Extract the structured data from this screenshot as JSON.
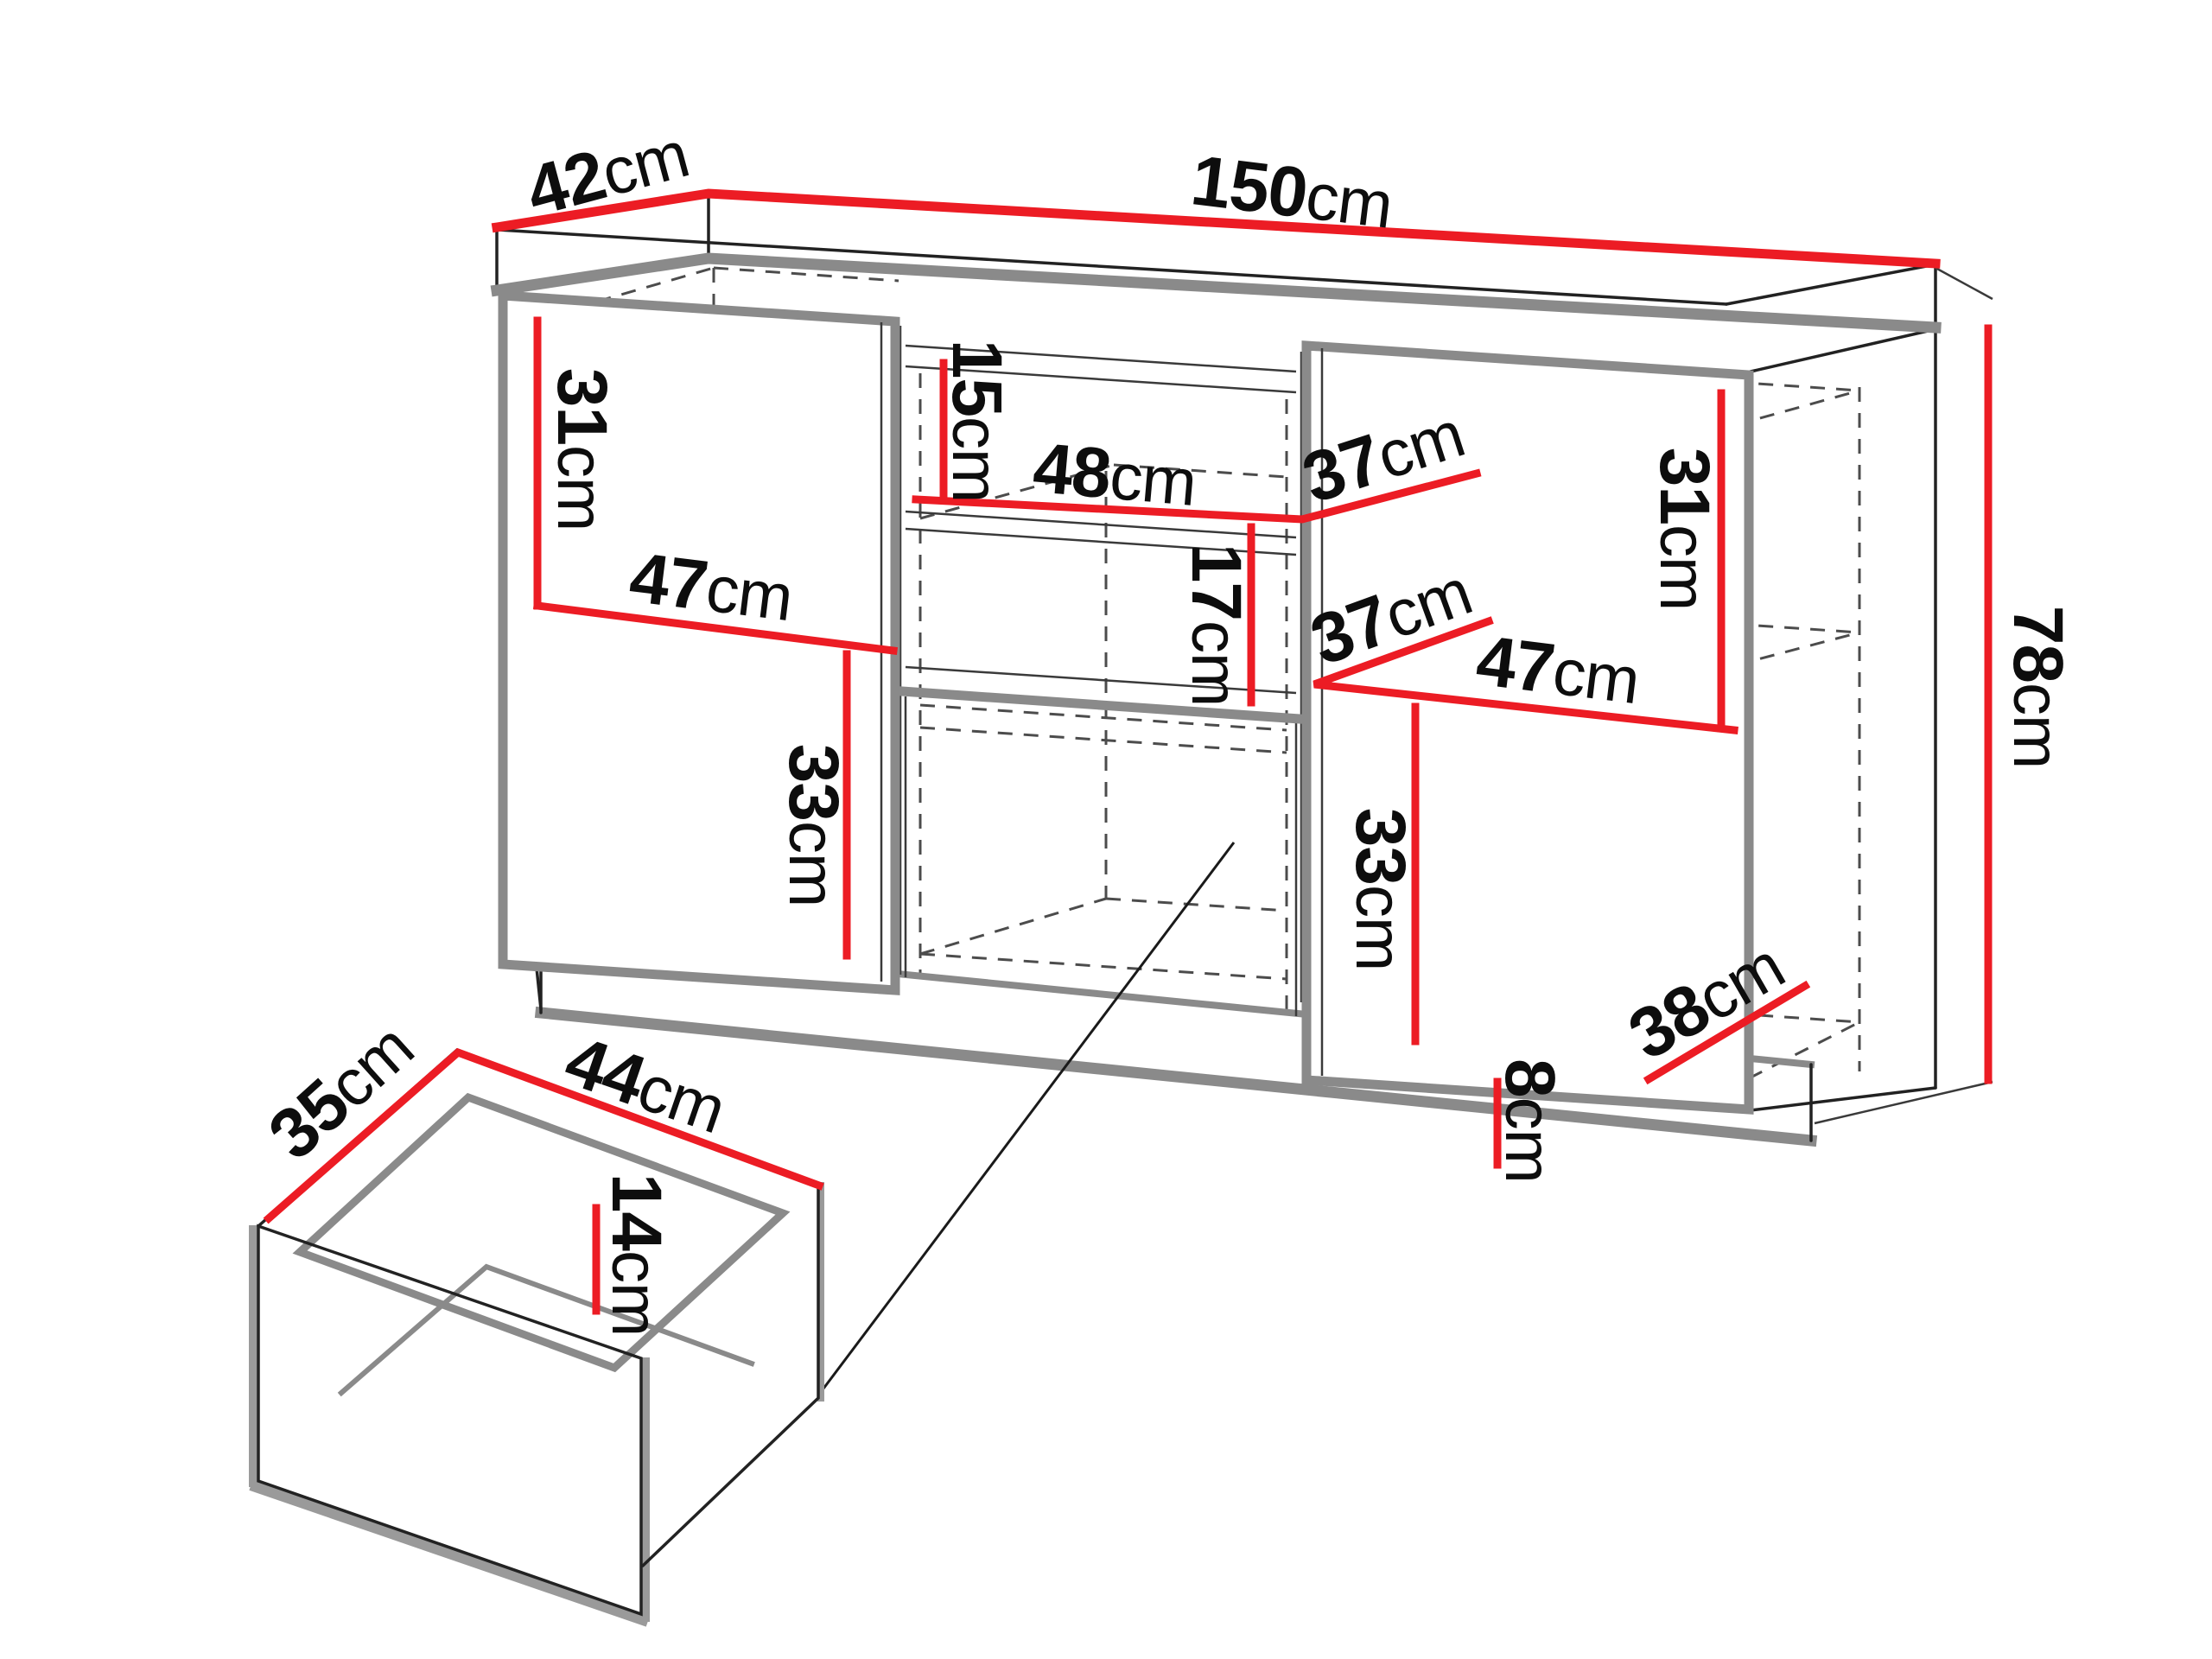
{
  "diagram": {
    "type": "furniture-dimension-drawing",
    "subject": "sideboard cabinet with separate drawer detail",
    "unit": "cm",
    "colors": {
      "dimension_accent": "#EC1C24",
      "panel_edge_gray": "#8a8a8a",
      "hidden_line_gray": "#4c4c4c",
      "outline_black": "#1a1a1a",
      "background": "#ffffff"
    },
    "cabinet": {
      "depth": {
        "num": "42",
        "unit": "cm"
      },
      "width": {
        "num": "150",
        "unit": "cm"
      },
      "height": {
        "num": "78",
        "unit": "cm"
      },
      "plinth_height": {
        "num": "8",
        "unit": "cm"
      },
      "left_upper_inner_height": {
        "num": "31",
        "unit": "cm"
      },
      "left_inner_width": {
        "num": "47",
        "unit": "cm"
      },
      "left_lower_inner_height": {
        "num": "33",
        "unit": "cm"
      },
      "middle_top_niche_height": {
        "num": "15",
        "unit": "cm"
      },
      "middle_niche_width": {
        "num": "48",
        "unit": "cm"
      },
      "middle_shelf_depth": {
        "num": "37",
        "unit": "cm"
      },
      "middle_lower_niche_height": {
        "num": "17",
        "unit": "cm"
      },
      "right_inner_depth": {
        "num": "37",
        "unit": "cm"
      },
      "right_inner_width": {
        "num": "47",
        "unit": "cm"
      },
      "right_upper_inner_height": {
        "num": "31",
        "unit": "cm"
      },
      "right_lower_inner_height": {
        "num": "33",
        "unit": "cm"
      },
      "bottom_inner_depth": {
        "num": "38",
        "unit": "cm"
      }
    },
    "drawer": {
      "depth": {
        "num": "35",
        "unit": "cm"
      },
      "width": {
        "num": "44",
        "unit": "cm"
      },
      "inner_height": {
        "num": "14",
        "unit": "cm"
      }
    }
  }
}
